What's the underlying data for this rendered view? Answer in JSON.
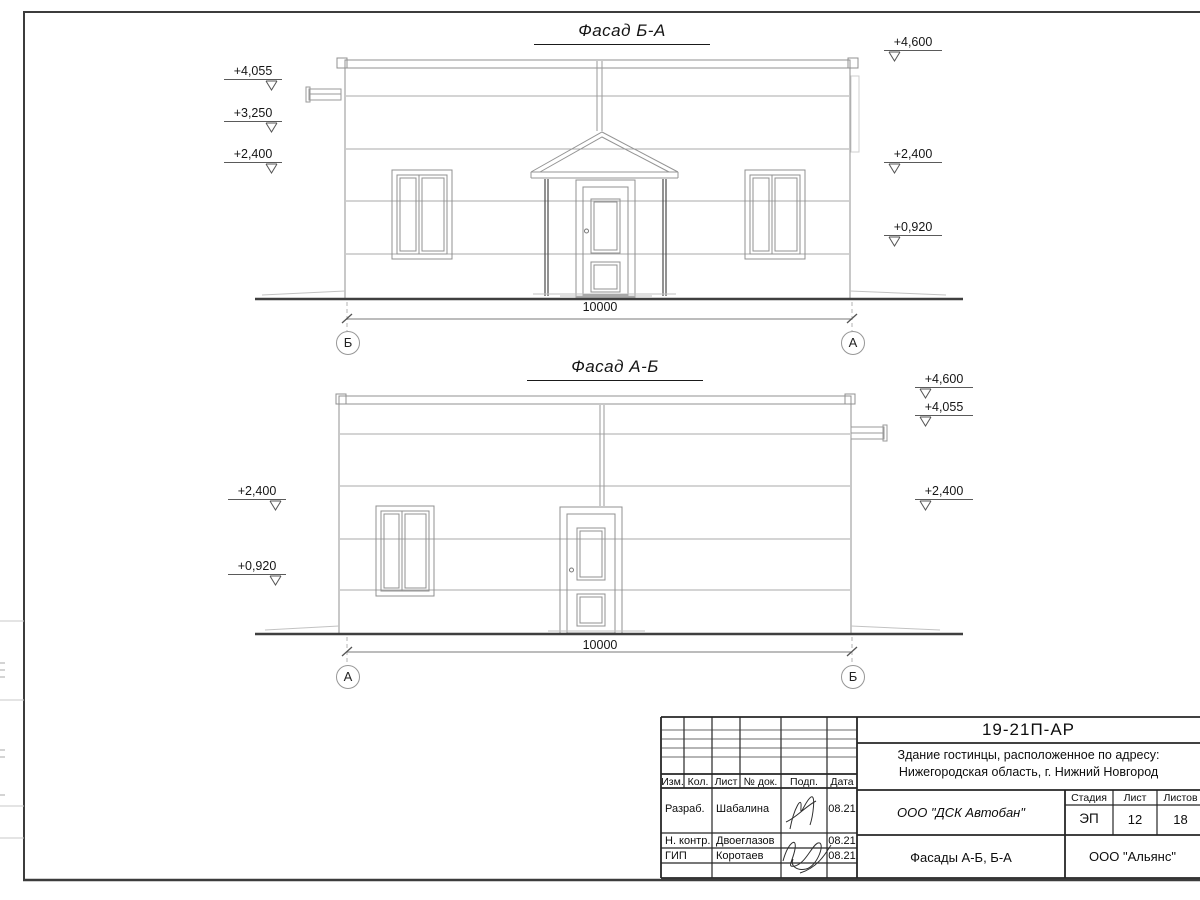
{
  "facade1": {
    "title": "Фасад Б-А",
    "dim": "10000",
    "axis_left": "Б",
    "axis_right": "А",
    "marks_left": [
      "+4,055",
      "+3,250",
      "+2,400"
    ],
    "marks_right": [
      "+4,600",
      "+2,400",
      "+0,920"
    ]
  },
  "facade2": {
    "title": "Фасад А-Б",
    "dim": "10000",
    "axis_left": "А",
    "axis_right": "Б",
    "marks_left": [
      "+2,400",
      "+0,920"
    ],
    "marks_right": [
      "+4,600",
      "+4,055",
      "+2,400"
    ]
  },
  "titleblock": {
    "doc_number": "19-21П-АР",
    "project_line1": "Здание гостинцы, расположенное по адресу:",
    "project_line2": "Нижегородская область, г. Нижний Новгород",
    "col_izm": "Изм.",
    "col_kol": "Кол.",
    "col_list": "Лист",
    "col_doc": "№ док.",
    "col_podp": "Подп.",
    "col_data": "Дата",
    "rows": [
      {
        "role": "Разраб.",
        "name": "Шабалина",
        "date": "08.21"
      },
      {
        "role": "Н. контр.",
        "name": "Двоеглазов",
        "date": "08.21"
      },
      {
        "role": "ГИП",
        "name": "Коротаев",
        "date": "08.21"
      }
    ],
    "company": "ООО \"ДСК Автобан\"",
    "stage_label": "Стадия",
    "sheet_label": "Лист",
    "sheets_label": "Листов",
    "stage": "ЭП",
    "sheet_number": "12",
    "sheets_total": "18",
    "drawing_title": "Фасады А-Б, Б-А",
    "contractor": "ООО \"Альянс\""
  }
}
